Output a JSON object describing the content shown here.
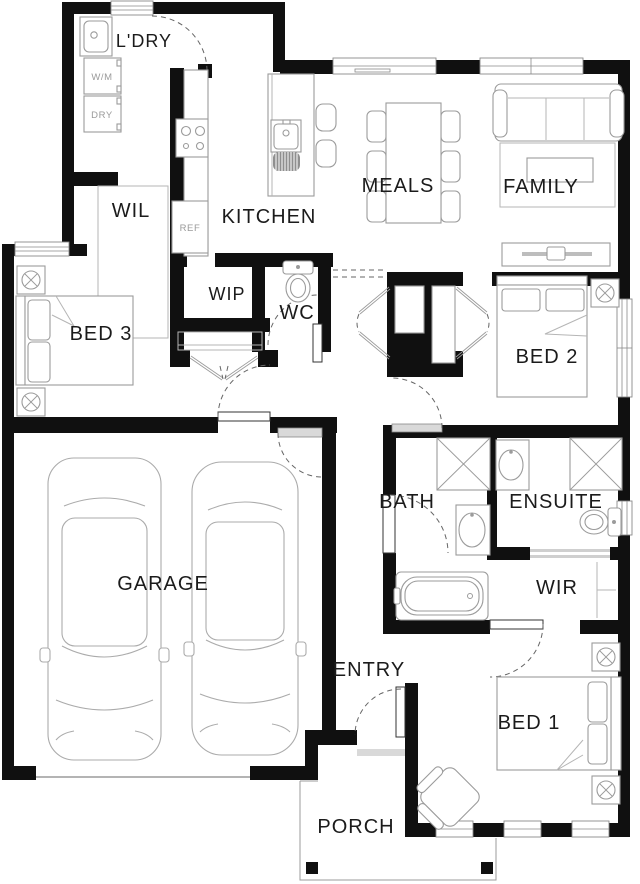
{
  "plan": {
    "title": "Single storey house floor plan",
    "rooms": {
      "ldry": "L'DRY",
      "wil": "WIL",
      "kitchen": "KITCHEN",
      "wip": "WIP",
      "wc": "WC",
      "meals": "MEALS",
      "family": "FAMILY",
      "bed3": "BED 3",
      "bed2": "BED 2",
      "garage": "GARAGE",
      "bath": "BATH",
      "ensuite": "ENSUITE",
      "wir": "WIR",
      "entry": "ENTRY",
      "bed1": "BED 1",
      "porch": "PORCH"
    },
    "appliances": {
      "washer": "W/M",
      "dryer": "DRY",
      "fridge": "REF"
    },
    "fixtures": [
      "laundry-tub-icon",
      "cooktop-icon",
      "kitchen-sink-icon",
      "fridge-icon",
      "toilet-icon",
      "shower-icon",
      "vanity-basin-icon",
      "bathtub-icon",
      "bed-icon",
      "downlight-icon",
      "sofa-icon",
      "rug",
      "coffee-table-icon",
      "tv-unit-icon",
      "dining-table-icon",
      "chair-icon",
      "stool-icon",
      "car-icon",
      "armchair-icon",
      "robe-icon",
      "porch-post"
    ],
    "colors": {
      "wall": "#101010",
      "furniture_line": "#9b9b9b",
      "label": "#1b1b1b",
      "appliance_label": "#9a9a9a"
    }
  }
}
